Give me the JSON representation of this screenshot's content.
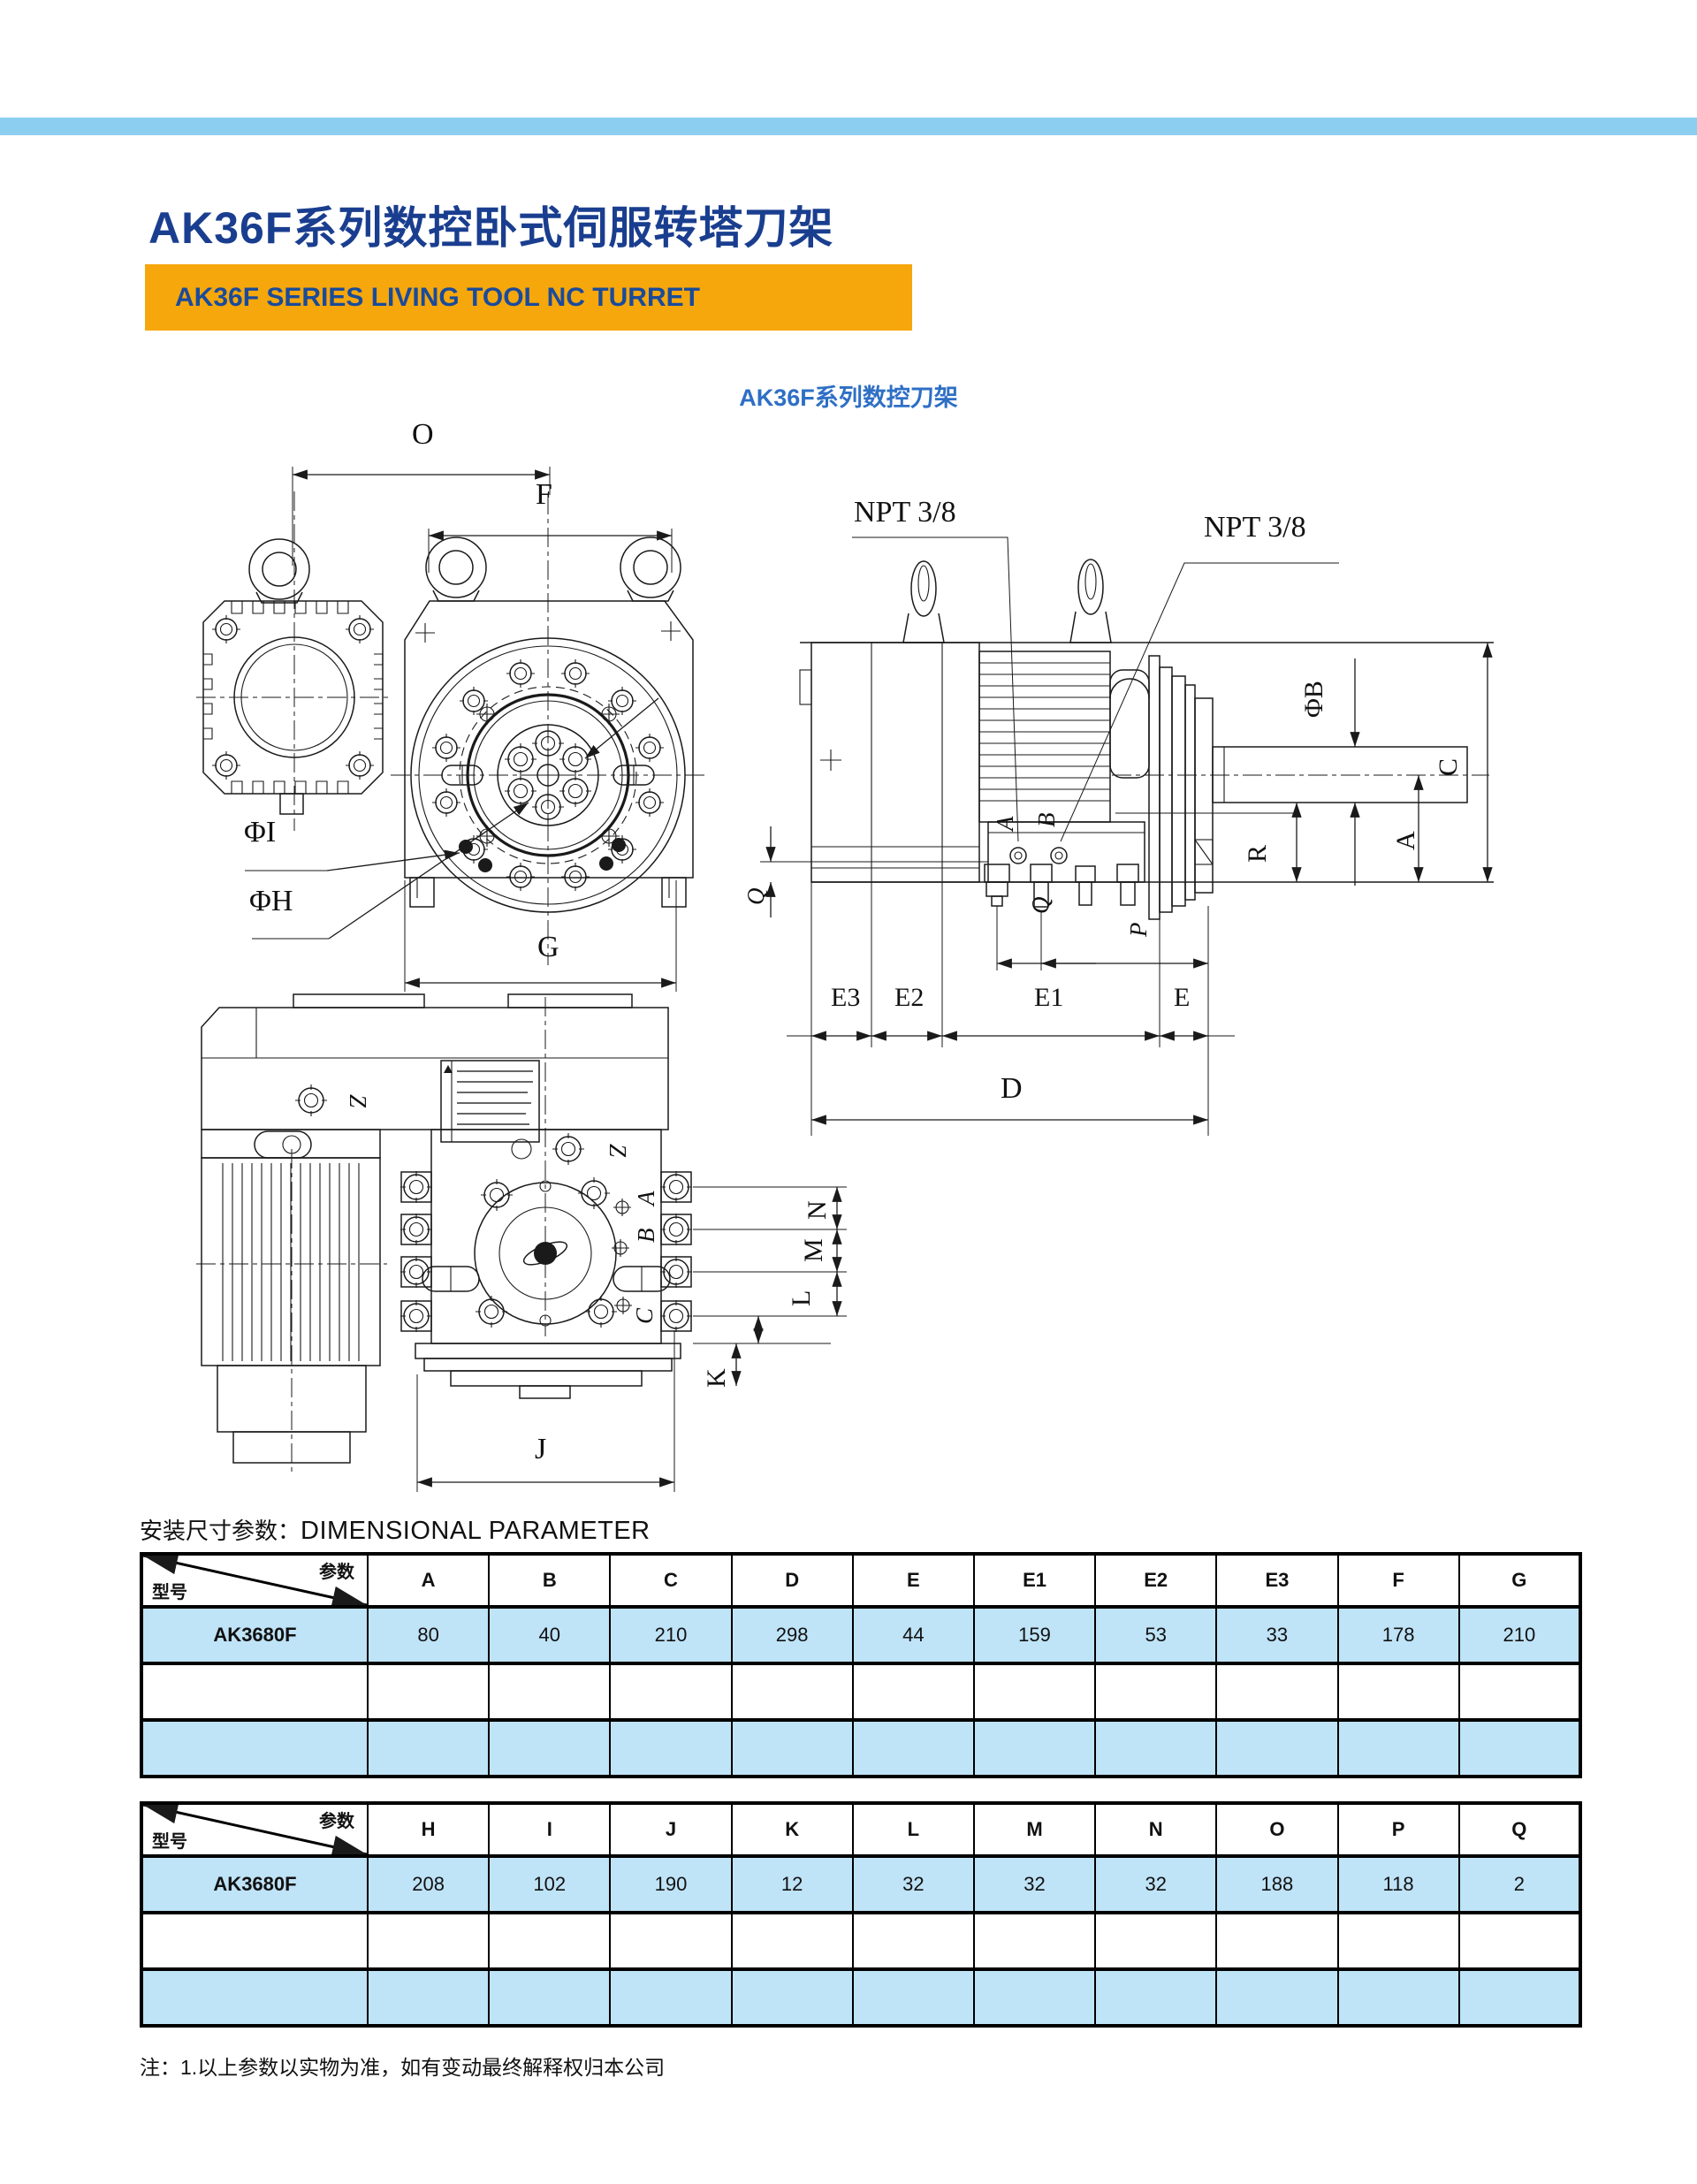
{
  "page": {
    "title": "AK36F系列数控卧式伺服转塔刀架",
    "banner": "AK36F SERIES LIVING TOOL NC TURRET",
    "drawing_caption": "AK36F系列数控刀架",
    "section_heading_cn": "安装尺寸参数：",
    "section_heading_en": "DIMENSIONAL PARAMETER",
    "note": "注：1.以上参数以实物为准，如有变动最终解释权归本公司"
  },
  "colors": {
    "top_bar": "#8CCEF0",
    "title_blue": "#1A3E8F",
    "banner_orange": "#F6A70B",
    "banner_text": "#1A4B9B",
    "caption_blue": "#2E6FC5",
    "row_blue": "#BFE3F7",
    "line_black": "#1a1a1a"
  },
  "front_view": {
    "o": "O",
    "f": "F",
    "phi_i": "ΦI",
    "phi_h": "ΦH",
    "g": "G"
  },
  "side_view": {
    "npt_top": "NPT 3/8",
    "npt_right": "NPT 3/8",
    "port_a": "A",
    "port_b": "B",
    "phi_b": "ΦB",
    "c": "C",
    "a": "A",
    "r": "R",
    "q_left": "Q",
    "q_stud": "Q",
    "p_stud": "P",
    "e3": "E3",
    "e2": "E2",
    "e1": "E1",
    "e": "E",
    "d": "D"
  },
  "top_view": {
    "z_rear": "Z",
    "z_front": "Z",
    "a": "A",
    "b": "B",
    "c": "C",
    "n": "N",
    "m": "M",
    "l": "L",
    "k": "K",
    "j": "J"
  },
  "dimension_table_1": {
    "corner_top": "参数",
    "corner_bottom": "型号",
    "columns": [
      "A",
      "B",
      "C",
      "D",
      "E",
      "E1",
      "E2",
      "E3",
      "F",
      "G"
    ],
    "rows": [
      {
        "model": "AK3680F",
        "values": [
          "80",
          "40",
          "210",
          "298",
          "44",
          "159",
          "53",
          "33",
          "178",
          "210"
        ]
      },
      {
        "model": "",
        "values": [
          "",
          "",
          "",
          "",
          "",
          "",
          "",
          "",
          "",
          ""
        ]
      },
      {
        "model": "",
        "values": [
          "",
          "",
          "",
          "",
          "",
          "",
          "",
          "",
          "",
          ""
        ]
      }
    ]
  },
  "dimension_table_2": {
    "corner_top": "参数",
    "corner_bottom": "型号",
    "columns": [
      "H",
      "I",
      "J",
      "K",
      "L",
      "M",
      "N",
      "O",
      "P",
      "Q"
    ],
    "rows": [
      {
        "model": "AK3680F",
        "values": [
          "208",
          "102",
          "190",
          "12",
          "32",
          "32",
          "32",
          "188",
          "118",
          "2"
        ]
      },
      {
        "model": "",
        "values": [
          "",
          "",
          "",
          "",
          "",
          "",
          "",
          "",
          "",
          ""
        ]
      },
      {
        "model": "",
        "values": [
          "",
          "",
          "",
          "",
          "",
          "",
          "",
          "",
          "",
          ""
        ]
      }
    ]
  }
}
